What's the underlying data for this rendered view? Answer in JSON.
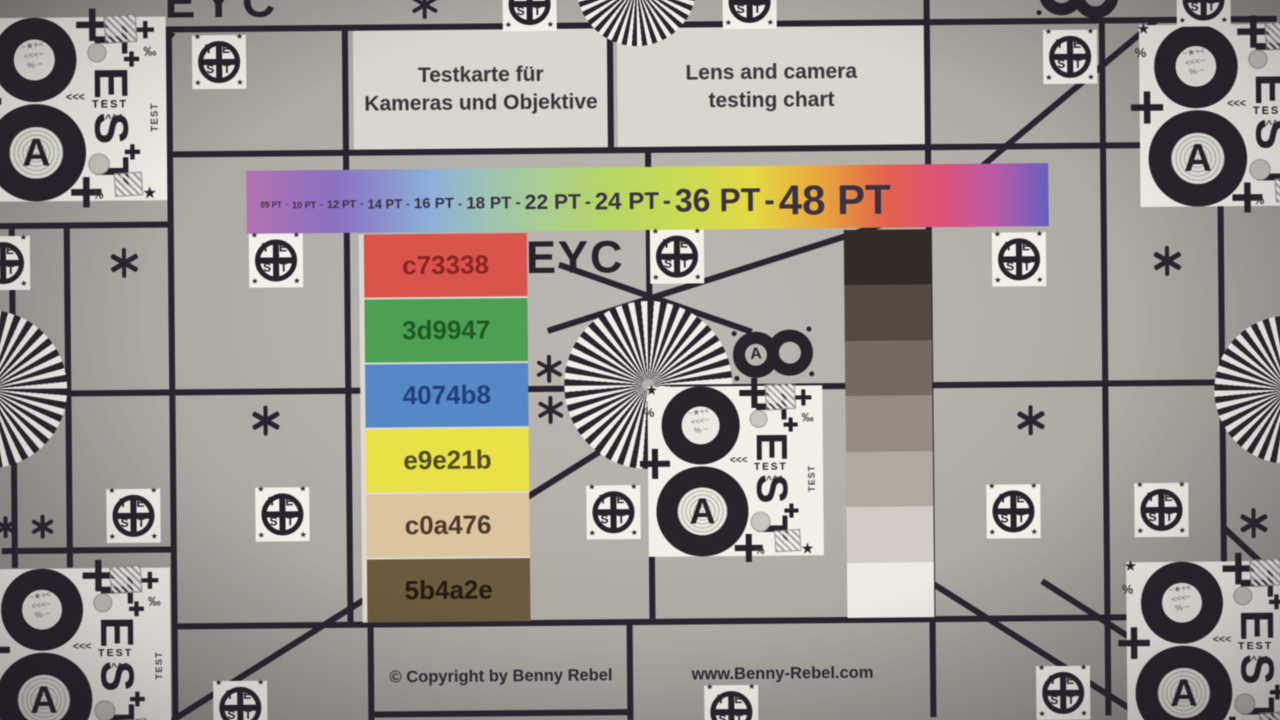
{
  "titles": {
    "german": [
      "Testkarte für",
      "Kameras und Objektive"
    ],
    "english": [
      "Lens and camera",
      "testing chart"
    ]
  },
  "eyc_label": "EYC",
  "font_bar": {
    "separator": "-",
    "gradient": [
      "#b671b4 0%",
      "#8a70c4 11%",
      "#8cb0dc 23%",
      "#9cc4b4 30%",
      "#a9cf8e 37%",
      "#b5d75f 45%",
      "#cfdc4a 56%",
      "#e4da3c 63%",
      "#eda437 72%",
      "#e66049 80%",
      "#e2517c 87%",
      "#c059a8 93%",
      "#6660c0 100%"
    ],
    "items": [
      {
        "label": "09 PT",
        "px": 8
      },
      {
        "label": "10 PT",
        "px": 9
      },
      {
        "label": "12 PT",
        "px": 11
      },
      {
        "label": "14 PT",
        "px": 13
      },
      {
        "label": "16 PT",
        "px": 15
      },
      {
        "label": "18 PT",
        "px": 17
      },
      {
        "label": "22 PT",
        "px": 21
      },
      {
        "label": "24 PT",
        "px": 24
      },
      {
        "label": "36 PT",
        "px": 32
      },
      {
        "label": "48 PT",
        "px": 42
      }
    ]
  },
  "color_patches": [
    {
      "label": "c73338",
      "bg": "#df5349",
      "text": "#8c2522"
    },
    {
      "label": "3d9947",
      "bg": "#4aa14f",
      "text": "#1d5a22"
    },
    {
      "label": "4074b8",
      "bg": "#5587cb",
      "text": "#1e3e80"
    },
    {
      "label": "e9e21b",
      "bg": "#ebe140",
      "text": "#4f4b22"
    },
    {
      "label": "c0a476",
      "bg": "#dcc49c",
      "text": "#4a3a28"
    },
    {
      "label": "5b4a2e",
      "bg": "#6b5a3c",
      "text": "#231b10"
    }
  ],
  "grayscale_steps": [
    "#332b25",
    "#544a40",
    "#746a60",
    "#968c82",
    "#b1a89e",
    "#d2ccc4",
    "#eeebe4"
  ],
  "footer": {
    "copyright": "© Copyright by Benny Rebel",
    "website": "www.Benny-Rebel.com"
  },
  "test_card": {
    "letter_a": "A",
    "test_letters": [
      "T",
      "E",
      "S",
      "T"
    ],
    "small_test": "TEST",
    "side_test": "TEST",
    "scribble_lines": [
      "~★+<",
      "<<<~",
      "%·~"
    ]
  },
  "test_marker": {
    "letters": [
      "T",
      "E",
      "S",
      "T"
    ],
    "corner_star": "★"
  },
  "colors": {
    "line": "#2b2330",
    "ink": "#29222b",
    "card_bg": "#f3f0e9",
    "ray_dark": "#2b242c",
    "ray_light": "#f2efe9",
    "label_ink": "#3a3144",
    "circle_fill": "#c9c5bf"
  },
  "layout": {
    "h_lines": [
      {
        "y": 25,
        "x1": 0,
        "x2": 1280
      },
      {
        "y": 150,
        "x1": 172,
        "x2": 1280
      },
      {
        "y": 220,
        "x1": 0,
        "x2": 172
      },
      {
        "y": 388,
        "x1": 0,
        "x2": 1280
      },
      {
        "y": 545,
        "x1": 0,
        "x2": 172
      },
      {
        "y": 622,
        "x1": 172,
        "x2": 1280
      },
      {
        "y": 712,
        "x1": 368,
        "x2": 630
      }
    ],
    "v_lines": [
      {
        "x": 13,
        "y1": 222,
        "y2": 562
      },
      {
        "x": 68,
        "y1": 222,
        "y2": 562
      },
      {
        "x": 172,
        "y1": 25,
        "y2": 720
      },
      {
        "x": 348,
        "y1": 25,
        "y2": 622
      },
      {
        "x": 368,
        "y1": 622,
        "y2": 720
      },
      {
        "x": 613,
        "y1": 28,
        "y2": 150
      },
      {
        "x": 648,
        "y1": 0,
        "y2": 25
      },
      {
        "x": 650,
        "y1": 150,
        "y2": 622
      },
      {
        "x": 627,
        "y1": 622,
        "y2": 720
      },
      {
        "x": 930,
        "y1": 0,
        "y2": 720
      },
      {
        "x": 1105,
        "y1": 25,
        "y2": 720
      },
      {
        "x": 1222,
        "y1": 150,
        "y2": 585
      }
    ],
    "diagonals": [
      {
        "x1": 148,
        "y1": 62,
        "x2": 176,
        "y2": 28
      },
      {
        "x1": 548,
        "y1": 330,
        "x2": 932,
        "y2": 212
      },
      {
        "x1": 932,
        "y1": 212,
        "x2": 1160,
        "y2": 25
      },
      {
        "x1": 560,
        "y1": 264,
        "x2": 752,
        "y2": 333
      },
      {
        "x1": 662,
        "y1": 413,
        "x2": 163,
        "y2": 720
      },
      {
        "x1": 1222,
        "y1": 533,
        "x2": 1284,
        "y2": 592
      },
      {
        "x1": 930,
        "y1": 586,
        "x2": 1137,
        "y2": 720
      },
      {
        "x1": 1040,
        "y1": 585,
        "x2": 1150,
        "y2": 657
      }
    ],
    "siemens_stars": [
      {
        "x": 648,
        "y": 385,
        "r": 84,
        "period": 9
      },
      {
        "x": -12,
        "y": 383,
        "r": 79,
        "period": 10
      },
      {
        "x": 1288,
        "y": 396,
        "r": 74,
        "period": 10
      },
      {
        "x": 640,
        "y": -14,
        "r": 60,
        "period": 10
      }
    ],
    "test_markers": [
      {
        "x": 222,
        "y": 58
      },
      {
        "x": 277,
        "y": 257
      },
      {
        "x": 678,
        "y": 257
      },
      {
        "x": 1020,
        "y": 263
      },
      {
        "x": 1073,
        "y": 61
      },
      {
        "x": 132,
        "y": 511
      },
      {
        "x": 281,
        "y": 511
      },
      {
        "x": 612,
        "y": 512
      },
      {
        "x": 1012,
        "y": 515
      },
      {
        "x": 1160,
        "y": 515
      },
      {
        "x": 533,
        "y": 3
      },
      {
        "x": 753,
        "y": 3
      },
      {
        "x": 1207,
        "y": 5
      },
      {
        "x": 4,
        "y": 257
      },
      {
        "x": 237,
        "y": 704
      },
      {
        "x": 728,
        "y": 713
      },
      {
        "x": 1060,
        "y": 697
      }
    ],
    "asterisks": [
      {
        "x": 125,
        "y": 258,
        "s": 30
      },
      {
        "x": 265,
        "y": 417,
        "s": 30
      },
      {
        "x": 4,
        "y": 521,
        "s": 22
      },
      {
        "x": 41,
        "y": 521,
        "s": 24
      },
      {
        "x": 549,
        "y": 368,
        "s": 28
      },
      {
        "x": 550,
        "y": 409,
        "s": 28
      },
      {
        "x": 428,
        "y": 3,
        "s": 28
      },
      {
        "x": 1168,
        "y": 266,
        "s": 30
      },
      {
        "x": 1030,
        "y": 424,
        "s": 30
      },
      {
        "x": 1252,
        "y": 529,
        "s": 30
      }
    ],
    "cards": [
      {
        "x": -20,
        "y": 12,
        "s": 1.08
      },
      {
        "x": -16,
        "y": 563,
        "s": 1.05
      },
      {
        "x": 1142,
        "y": 30,
        "s": 1.07
      },
      {
        "x": 1124,
        "y": 567,
        "s": 1.05
      },
      {
        "x": 647,
        "y": 387,
        "s": 1
      }
    ],
    "small_eights": [
      {
        "x": 733,
        "y": 330,
        "rot": -3
      },
      {
        "x": 1042,
        "y": -27,
        "rot": 6
      }
    ],
    "rainbow": {
      "x": 248,
      "y": 167,
      "w": 802,
      "h": 63
    },
    "patches": {
      "x": 360,
      "y": 232,
      "w": 168,
      "h": 388
    },
    "wedge": {
      "x": 845,
      "y": 232,
      "w": 87,
      "h": 388
    },
    "card_decorations": [
      {
        "t": "plus",
        "x": 92,
        "y": -8,
        "s": 30
      },
      {
        "t": "plus",
        "x": -8,
        "y": 62,
        "s": 30
      },
      {
        "t": "plus",
        "x": 86,
        "y": 148,
        "s": 28
      },
      {
        "t": "plus",
        "x": 136,
        "y": 32,
        "s": 14
      },
      {
        "t": "plus",
        "x": 136,
        "y": 118,
        "s": 14
      },
      {
        "t": "plus",
        "x": 148,
        "y": 4,
        "s": 16
      },
      {
        "t": "star",
        "x": -2,
        "y": -4,
        "s": 14
      },
      {
        "t": "star",
        "x": 152,
        "y": 156,
        "s": 15
      },
      {
        "t": "txt",
        "ch": "%",
        "x": -4,
        "y": 20,
        "s": 12
      },
      {
        "t": "txt",
        "ch": "%",
        "x": 106,
        "y": 160,
        "s": 11
      },
      {
        "t": "txt",
        "ch": "‰",
        "x": 154,
        "y": 26,
        "s": 12
      },
      {
        "t": "txt",
        "ch": "<<<",
        "x": 82,
        "y": 70,
        "s": 10
      },
      {
        "t": "txt",
        "ch": "^^^",
        "x": 118,
        "y": 90,
        "s": 10
      },
      {
        "t": "circle",
        "x": 102,
        "y": 24,
        "d": 18
      },
      {
        "t": "circle",
        "x": 102,
        "y": 126,
        "d": 20
      },
      {
        "t": "sketch",
        "x": 118,
        "y": -2,
        "w": 30,
        "h": 26
      },
      {
        "t": "sketch",
        "x": 126,
        "y": 144,
        "w": 26,
        "h": 22
      }
    ]
  }
}
